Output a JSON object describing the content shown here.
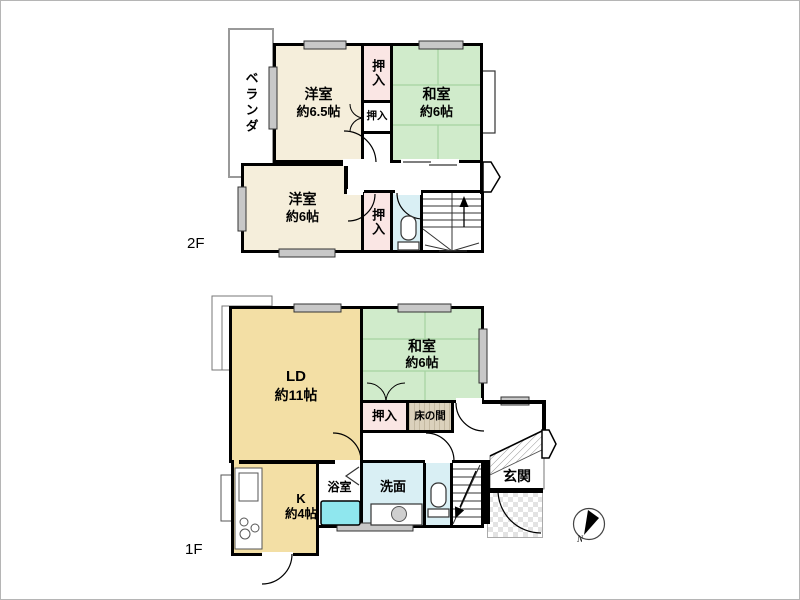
{
  "title": "2-story house floor plan",
  "floor2": {
    "label": "2F",
    "veranda_label": "ベランダ",
    "western_65": {
      "name": "洋室",
      "size": "約6.5帖"
    },
    "japanese_6": {
      "name": "和室",
      "size": "約6帖"
    },
    "western_6": {
      "name": "洋室",
      "size": "約6帖"
    },
    "closet_top": "押入",
    "closet_mid": "押入",
    "closet_bottom": "押入"
  },
  "floor1": {
    "label": "1F",
    "living_dining": {
      "name": "LD",
      "size": "約11帖"
    },
    "japanese_6": {
      "name": "和室",
      "size": "約6帖"
    },
    "kitchen": {
      "name": "K",
      "size": "約4帖"
    },
    "closet": "押入",
    "tokonoma": "床の間",
    "bath": "浴室",
    "washroom": "洗面",
    "entrance": "玄関"
  },
  "compass": {
    "label": "N"
  },
  "colors": {
    "western_room": "#F5EEDB",
    "tatami_room": "#D0EBCB",
    "tatami_line": "#A5D3A0",
    "closet": "#FAE6E4",
    "ld_kitchen": "#F3DFA5",
    "wet_room": "#D9EFF4",
    "bathtub": "#8FE7EE",
    "tokonoma": "#DBD1BC",
    "wall": "#000000"
  }
}
